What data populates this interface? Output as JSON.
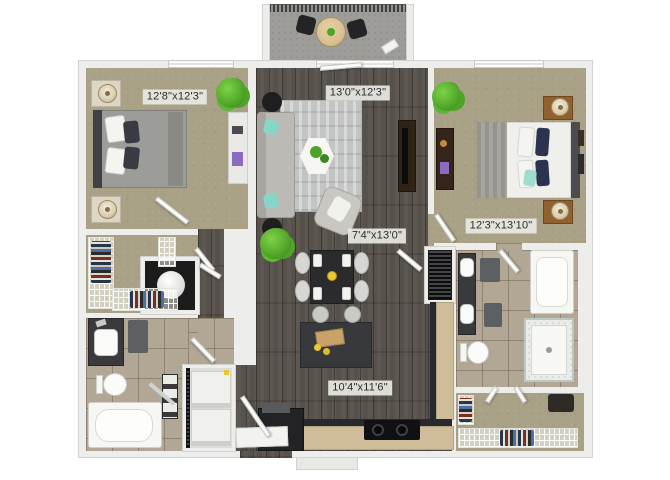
{
  "rooms": {
    "bedroom_1": {
      "dimensions": "12'8\"x12'3\""
    },
    "living_room": {
      "dimensions": "13'0\"x12'3\""
    },
    "bedroom_2": {
      "dimensions": "12'3\"x13'10\""
    },
    "dining_area": {
      "dimensions": "7'4\"x13'0\""
    },
    "kitchen": {
      "dimensions": "10'4\"x11'6\""
    }
  },
  "colors": {
    "wall": "#edeeec",
    "carpet": "#a8a186",
    "hardwood": "#57514b",
    "tile": "#b2a795",
    "kitchen_counter": "#cfbd99",
    "cabinet_dark": "#27292c",
    "accent_teal": "#85d6c8",
    "accent_navy": "#2b3350",
    "plant_green": "#55b42e",
    "label_background": "#e9e9e4",
    "label_text": "#2b2b2b"
  }
}
